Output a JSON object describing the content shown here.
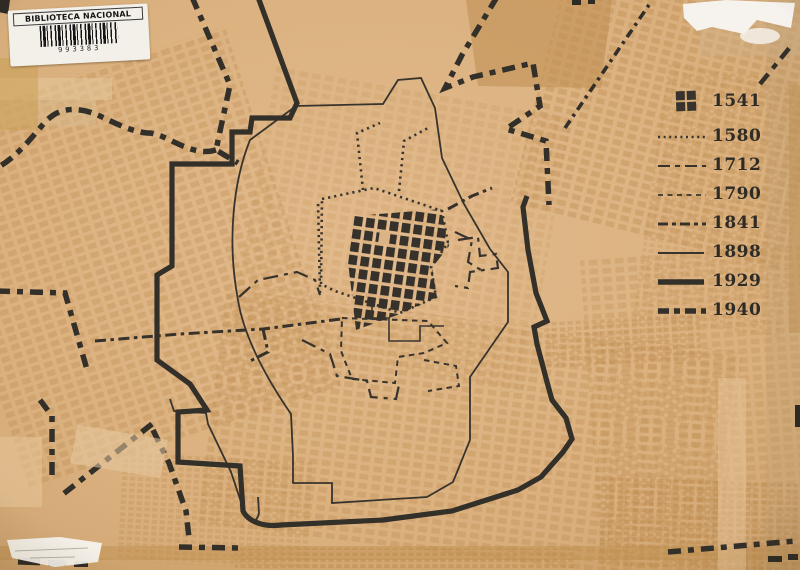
{
  "label_sticker": {
    "title": "BIBLIOTECA NACIONAL",
    "barcode_number": "993383"
  },
  "legend": {
    "items": [
      {
        "year": "1541",
        "style": "solid-blocks"
      },
      {
        "year": "1580",
        "style": "dotted"
      },
      {
        "year": "1712",
        "style": "long-dash"
      },
      {
        "year": "1790",
        "style": "short-dash"
      },
      {
        "year": "1841",
        "style": "dash-dot"
      },
      {
        "year": "1898",
        "style": "thin-solid"
      },
      {
        "year": "1929",
        "style": "thick-solid"
      },
      {
        "year": "1940",
        "style": "thick-dash"
      }
    ]
  },
  "colors": {
    "paper": "#dcb384",
    "ink": "#35312b",
    "faded_blocks": "#bb8a4e",
    "tape": "#c49257",
    "sticker_white": "#f3f0e9"
  }
}
